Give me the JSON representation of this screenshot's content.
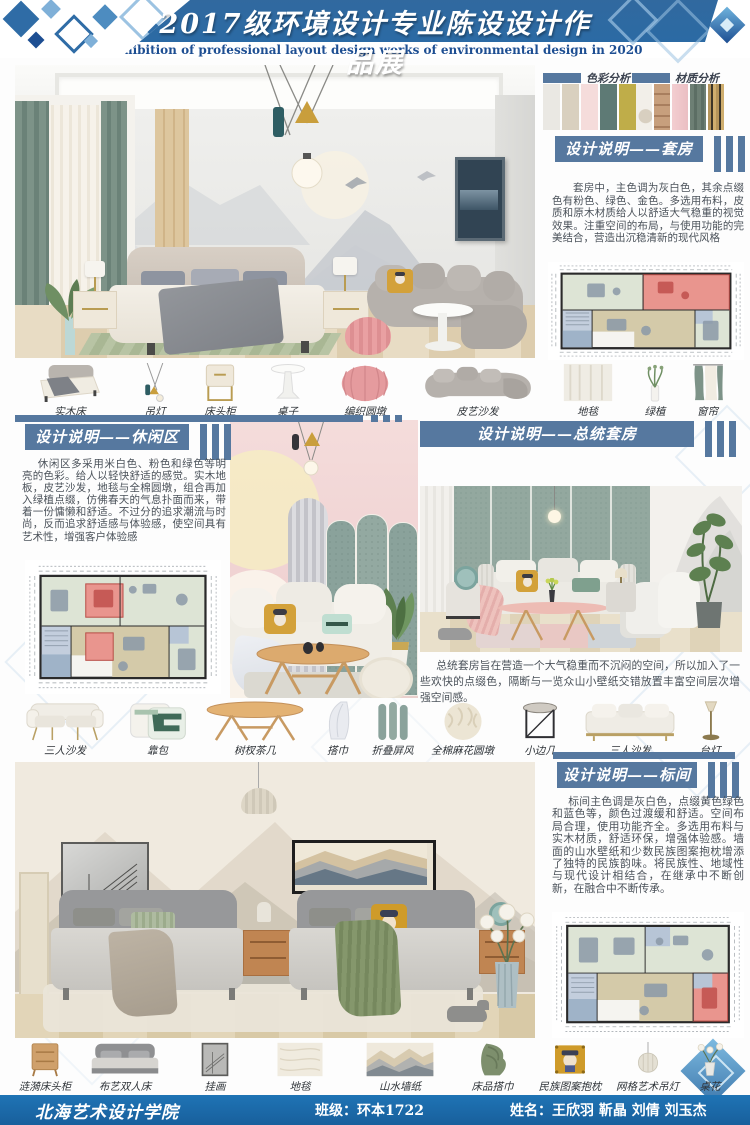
{
  "header": {
    "title": "2017级环境设计专业陈设设计作品展",
    "subtitle": "Exhibition of professional layout design works of environmental design in 2020"
  },
  "analysis": {
    "color_label": "色彩分析",
    "material_label": "材质分析",
    "color_swatches": [
      "#eae8e3",
      "#d9d0bf",
      "#f5dcdb",
      "#5e7a75",
      "#bfad49"
    ]
  },
  "sections": {
    "suite": {
      "title": "设计说明——套房",
      "body": "套房中，主色调为灰白色，其余点缀色有粉色、绿色、金色。多选用布料，皮质和原木材质给人以舒适大气稳重的视觉效果。注重空间的布局，与使用功能的完美结合，营造出沉稳清新的现代风格"
    },
    "leisure": {
      "title": "设计说明——休闲区",
      "body": "休闲区多采用米白色、粉色和绿色等明亮的色彩。给人以轻快舒适的感觉。实木地板，皮艺沙发，地毯与全棉圆墩，组合再加入绿植点缀，仿佛春天的气息扑面而来，带着一份慵懒和舒适。不过分的追求潮流与时尚，反而追求舒适感与体验感，使空间具有艺术性，增强客户体验感"
    },
    "presidential": {
      "title": "设计说明——总统套房",
      "body": "总统套房旨在营造一个大气稳重而不沉闷的空间，所以加入了一些欢快的点缀色，隔断与一览众山小壁纸交错放置丰富空间层次增强空间感。"
    },
    "standard": {
      "title": "设计说明——标间",
      "body": "标间主色调是灰白色，点缀黄色绿色和蓝色等，颜色过渡缓和舒适。空间布局合理，使用功能齐全。多选用布料与实木材质，舒适环保，增强体验感。墙面的山水壁纸和少数民族图案抱枕增添了独特的民族韵味。将民族性、地域性与现代设计相结合，在继承中不断创新，在融合中不断传承。"
    }
  },
  "furniture_rows": {
    "row1": [
      "实木床",
      "吊灯",
      "床头柜",
      "桌子",
      "编织圆墩",
      "皮艺沙发",
      "地毯",
      "绿植",
      "窗帘"
    ],
    "row2": [
      "三人沙发",
      "靠包",
      "树杈茶几",
      "搭巾",
      "折叠屏风",
      "全棉麻花圆墩",
      "小边几",
      "三人沙发",
      "台灯"
    ],
    "row3": [
      "涟漪床头柜",
      "布艺双人床",
      "挂画",
      "地毯",
      "山水墙纸",
      "床品搭巾",
      "民族图案抱枕",
      "网格艺术吊灯",
      "桌花"
    ]
  },
  "footer": {
    "school": "北海艺术设计学院",
    "class_label": "班级：",
    "class_value": "环本1722",
    "name_label": "姓名：",
    "name_value": "王欣羽 靳晶 刘倩 刘玉杰"
  },
  "palette": {
    "header_blue": "#2b6aa4",
    "steel_blue": "#56789f",
    "footer_blue": "#1a6bad",
    "body_text": "#4b525a",
    "plan_highlight_red": "#e9958e",
    "plan_room_green": "#dde4d5",
    "plan_corridor_tan": "#d4caa9",
    "plan_room_blue": "#b7c5d6"
  }
}
